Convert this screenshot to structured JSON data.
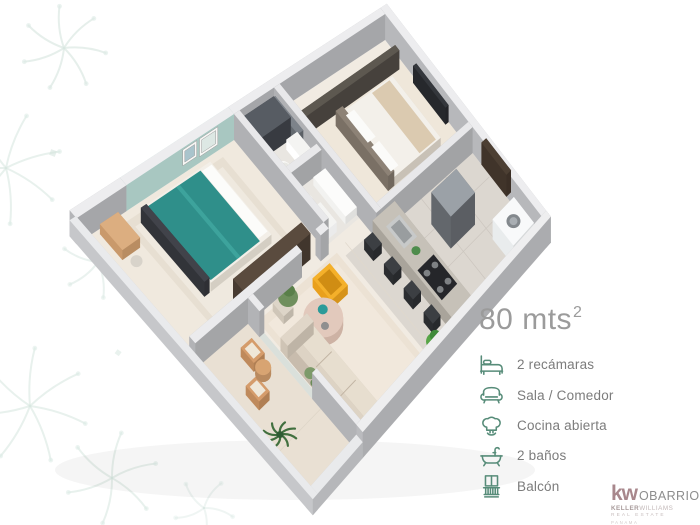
{
  "panel": {
    "area_value": "80 mts",
    "area_sup": "2",
    "features": [
      {
        "icon": "bed-icon",
        "label": "2 recámaras"
      },
      {
        "icon": "sofa-icon",
        "label": "Sala / Comedor"
      },
      {
        "icon": "chef-hat-icon",
        "label": "Cocina abierta"
      },
      {
        "icon": "bathtub-icon",
        "label": "2 baños"
      },
      {
        "icon": "balcony-icon",
        "label": "Balcón"
      }
    ]
  },
  "logo": {
    "kw": "kw",
    "office": "OBARRIO",
    "brand_bold": "KELLER",
    "brand_light": "WILLIAMS",
    "tagline": "REAL ESTATE",
    "region": "PANAMA"
  },
  "colors": {
    "feature_icon_green": "#578c79",
    "feature_label_gray": "#7c7c7c",
    "area_text_gray": "#9b9b9b",
    "accent_wall_teal": "#b7d8d2",
    "bed_teal": "#2f8f8a",
    "armchair_yellow": "#e9a01d",
    "logo_kw": "#a8878c",
    "watermark_leaf": "#d8e7e1"
  }
}
